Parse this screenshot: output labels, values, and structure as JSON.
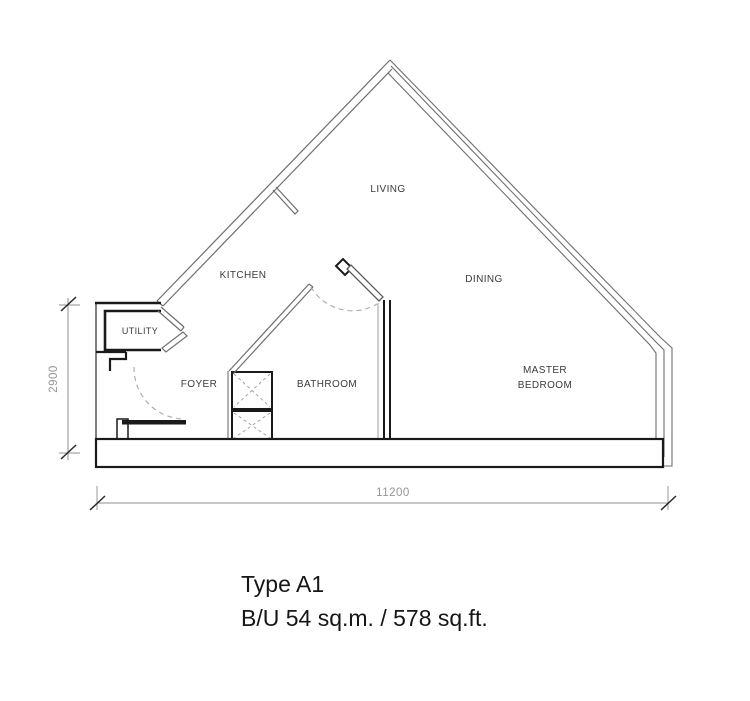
{
  "floorplan": {
    "unit_type": "Type A1",
    "rooms": [
      {
        "id": "living",
        "label": "LIVING"
      },
      {
        "id": "kitchen",
        "label": "KITCHEN"
      },
      {
        "id": "dining",
        "label": "DINING"
      },
      {
        "id": "utility",
        "label": "UTILITY"
      },
      {
        "id": "foyer",
        "label": "FOYER"
      },
      {
        "id": "bathroom",
        "label": "BATHROOM"
      },
      {
        "id": "master_bedroom",
        "label_line1": "MASTER",
        "label_line2": "BEDROOM"
      }
    ],
    "dimensions": {
      "horizontal": "11200",
      "vertical": "2900"
    },
    "title": {
      "line1": "Type A1",
      "line2": "B/U 54 sq.m. / 578 sq.ft."
    },
    "colors": {
      "background": "#ffffff",
      "wall_thin": "#6e6e6e",
      "wall_thick": "#1a1a1a",
      "dashed_swing": "#a8a8a8",
      "dimension_line": "#8f8f8f",
      "dimension_text": "#969696",
      "label_text": "#3b3b3b",
      "title_text": "#161616"
    }
  }
}
